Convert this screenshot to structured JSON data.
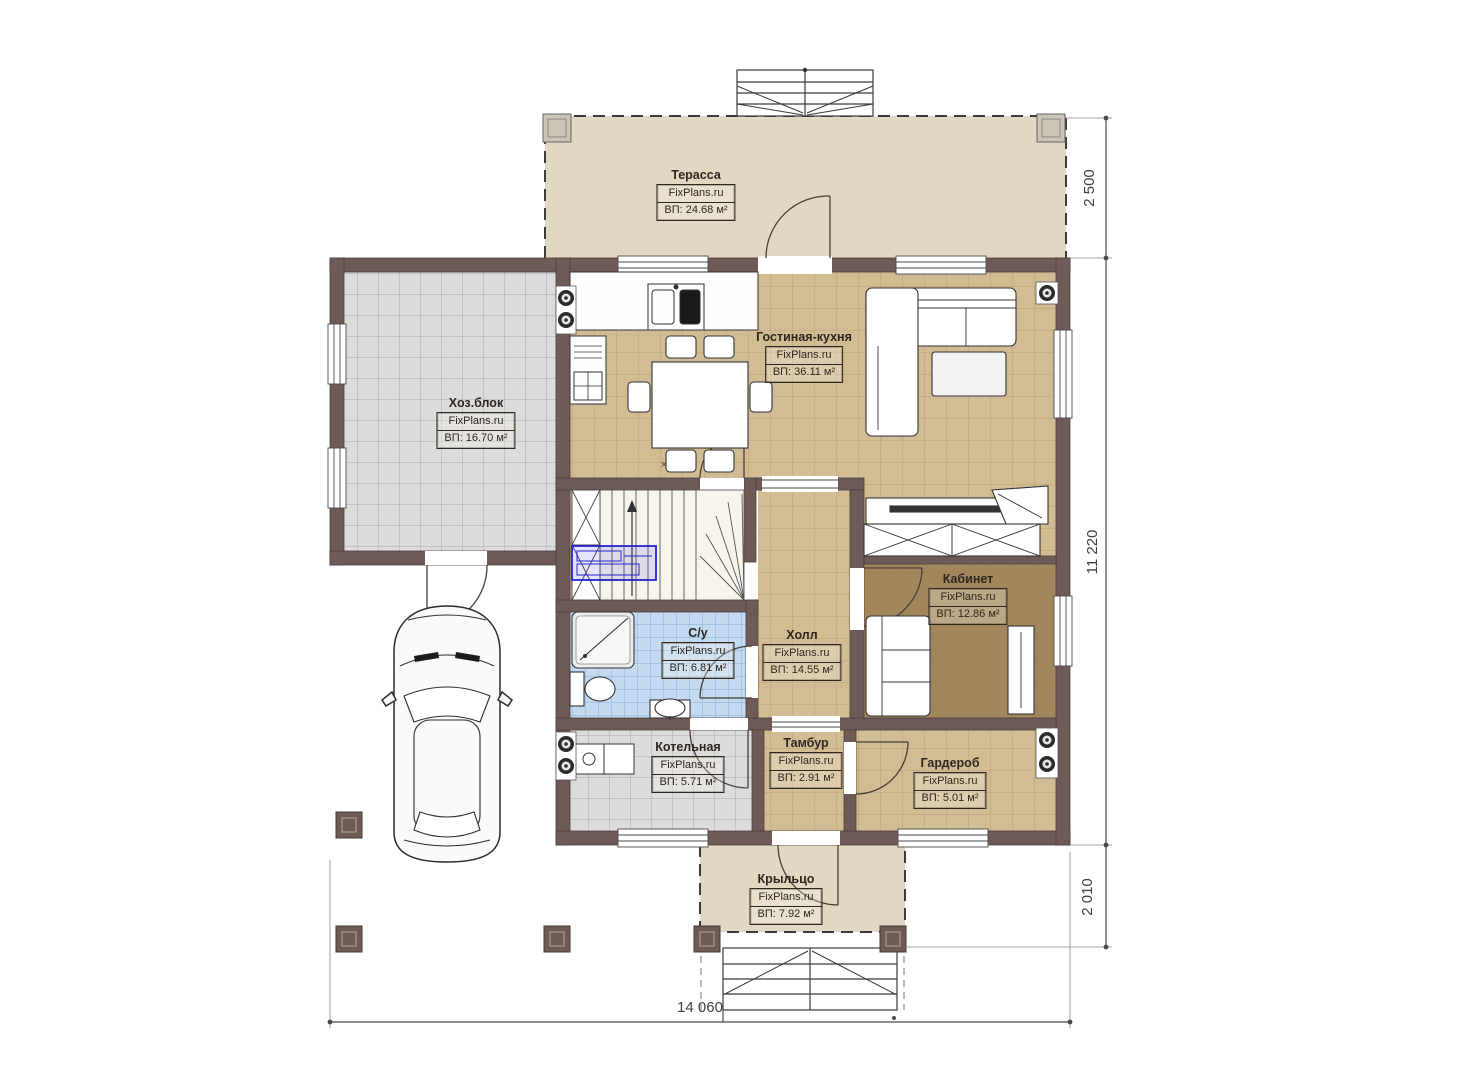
{
  "brand": "FixPlans.ru",
  "rooms": [
    {
      "name": "Терасса",
      "area": "ВП: 24.68 м²"
    },
    {
      "name": "Хоз.блок",
      "area": "ВП: 16.70 м²"
    },
    {
      "name": "Гостиная-кухня",
      "area": "ВП: 36.11 м²"
    },
    {
      "name": "Кабинет",
      "area": "ВП: 12.86 м²"
    },
    {
      "name": "С/у",
      "area": "ВП: 6.81 м²"
    },
    {
      "name": "Холл",
      "area": "ВП: 14.55 м²"
    },
    {
      "name": "Котельная",
      "area": "ВП: 5.71 м²"
    },
    {
      "name": "Тамбур",
      "area": "ВП: 2.91 м²"
    },
    {
      "name": "Гардероб",
      "area": "ВП: 5.01 м²"
    },
    {
      "name": "Крыльцо",
      "area": "ВП: 7.92 м²"
    }
  ],
  "dimensions": {
    "right_top": "2 500",
    "right_middle": "11 220",
    "right_bottom": "2 010",
    "bottom": "14 060"
  },
  "misc": {
    "cross_marker": "×"
  },
  "colors": {
    "wall": "#6e5b57",
    "floor_tan": "#d2bc94",
    "floor_gray": "#dcdcdc",
    "floor_blue": "#c3daf1",
    "floor_kabinet": "#a3875c",
    "terrace": "#e2d7c2",
    "annotation": "#2525cd"
  }
}
